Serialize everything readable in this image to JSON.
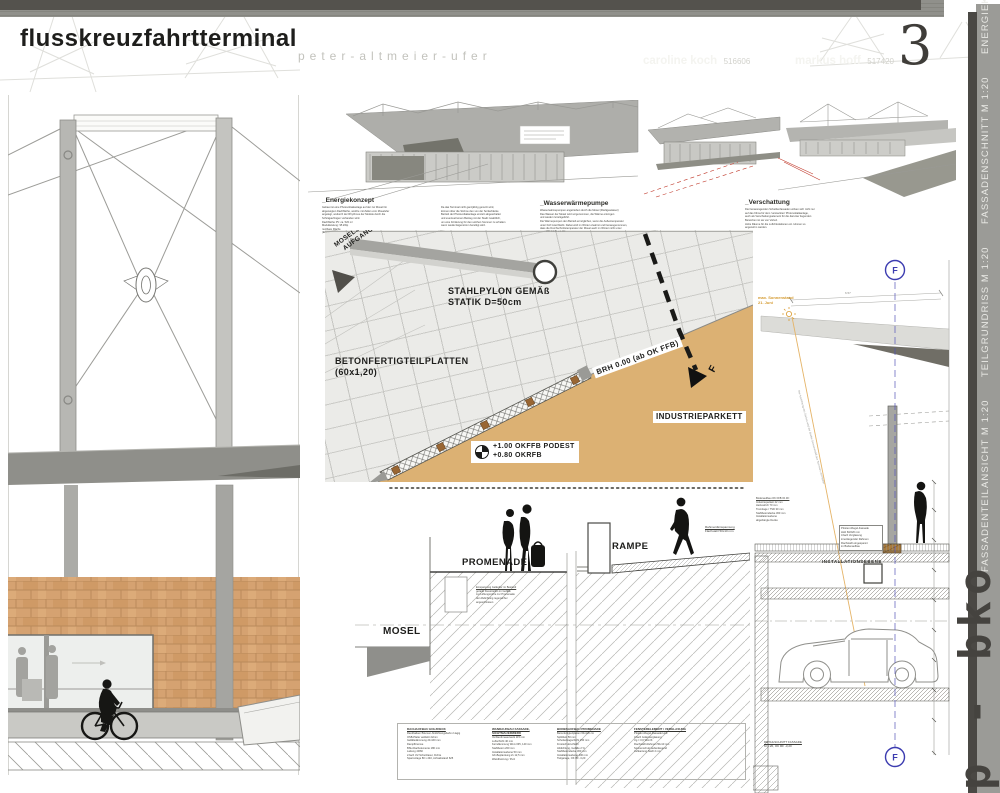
{
  "header": {
    "title": "flusskreuzfahrtterminal",
    "subtitle": "peter-altmeier-ufer",
    "authors": [
      {
        "name": "caroline koch",
        "id": "516606"
      },
      {
        "name": "markus hoff",
        "id": "517420"
      }
    ],
    "sheet_number": "3"
  },
  "sidebar": {
    "label": "FASSADENTEILANSICHT M 1:20      TEILGRUNDRISS M 1:20      FASSADENSCHNITT M 1:20      ENERGIEKONZEPT"
  },
  "signature": "p - bko",
  "colors": {
    "accent_blue": "#3c3cb0",
    "accent_orange": "#d99a2e",
    "tan": "#dcb173",
    "brick": "#d5a271",
    "band_gray": "#8d8d88",
    "band_dark": "#54524d"
  },
  "renderings": {
    "captions": [
      {
        "title": "_Energiekonzept",
        "col1": [
          "Gebaut ist eine Photovoltaikanlage auf der zur Mosel hin",
          "abgeneigten Dachfläche, welche mit Zellen vom Moselufer",
          "angelegt, wodurch der Rhythmus der Module durch die",
          "Schrägaufzügen vorhanden wird.",
          "Dachfläche PV: ca. 520 m²",
          "Modulleistung: 95 kWp",
          "nutzbare Fläche",
          "(Eigenwert)"
        ],
        "col2": [
          "Da das Terminal nicht ganzjährig genutzt wird,",
          "können über die Ströme den von der Sortierbänke",
          "Betrieb der Photovoltaikanlage einzeln abgeschaltet",
          "und eventuell einen Beitrag mit der Stadt zusätzlich,",
          "um eine Förderung für den solchen Sommer zu erhalten",
          "wenn wieder Eigenstrom benötigt wird."
        ]
      },
      {
        "title": "_Wasserwärmepumpe",
        "col1": [
          "Wasserwärmepumpen angetrieben durch die Mosel (Fließgewässer)",
          "Das Wasser der Mosel wird vorgenommen, die Wärme entzogen",
          "und wieder zurückgeführt.",
          "Die Wärmepumpen den Betrieb ermöglichen, wenn die Außentemperatur",
          "unter fünf Grad bleibt. Dabei wird im Winter erwärmt und herausgenommen,",
          "dass die Durchschnittstemperatur der Mosel auch im Winter nicht unter",
          "4,5 Grad fällt."
        ]
      },
      {
        "title": "_Verschattung",
        "col1": [
          "Die herausragenden Scheibenfassaden wirken sich nicht nur",
          "auf das Klima für dem 'versteckten' Photovoltaikanlage,",
          "auch als Verschattungselement für die darunter liegenden",
          "Bereichen ist sie von Vorteil.",
          "Hohe Räume für die Luftzirkulationen etc. können so",
          "angenehm werden."
        ]
      }
    ]
  },
  "plan": {
    "aufgang1": "MOSELSEITE",
    "aufgang2": "AUFGANG",
    "pylon1": "STAHLPYLON GEMÄß",
    "pylon2": "STATIK D=50cm",
    "beton1": "BETONFERTIGTEILPLATTEN",
    "beton2": "(60x1,20)",
    "brh": "BRH 0.00 (ab OK FFB)",
    "parkett": "INDUSTRIEPARKETT",
    "podest1": "+1.00 OKFFB PODEST",
    "podest2": "+0.80 OKRFB",
    "f": "F",
    "top_note": "OK FFB +1.00"
  },
  "section": {
    "promenade": "PROMENADE",
    "rampe": "RAMPE",
    "mosel": "MOSEL",
    "rahmen": [
      "Rahmen/Einspannung",
      "Flachstahl 50x10 mm"
    ],
    "ground_note": [
      "Einspannung Geländer im Bestand",
      "gerade Kiesstreifen im Gefälle",
      "zur Lüftungsrohre zur Promenade",
      "der Abdichtung regensicher",
      "angeschlossen"
    ]
  },
  "detail": {
    "sun1": "max. Sonnenstand",
    "sun2": "21. Juni",
    "sun_note": "Bei Ausrichtung des Daches wird der direkte Sonneneinfall des Sommers vermieden",
    "installationsebene": "INSTALLATIONSEBENE",
    "f": "F",
    "dim": "6.57",
    "left_note": [
      "Bodenaufbau OK FFB ±0.00:",
      "Industrieparkett 22 mm",
      "Heizestrich 70 mm",
      "Trennlage / TSD 30 mm",
      "Stahlbetondecke 300 mm",
      "Installationsebene",
      "abgehängte Decke"
    ],
    "window_note": [
      "Pfosten-Riegel-Fassade",
      "Holz 60/220 mm",
      "3-fach Verglasung",
      "innenliegender Rahmen",
      "Flachstahl eingespannt",
      "im Bodenaufbau"
    ],
    "bottom_note": [
      "DETAILSCHNITT FASSADE",
      "M 1:20, OK RF -3,20"
    ]
  },
  "legend": {
    "columns": [
      {
        "header": "DACHAUFBAU HOLZDECK",
        "lines": [
          "Randbalken Bitumen Abdichtungsbahn 2-lagig",
          "OSB-Platte verklebt 22mm",
          "Gefälledämmung 20-160 mm",
          "Dampfbremse",
          "BSH-Dachelemente 180 mm",
          "Lattung 40/60",
          "2-fach UV-Schutzlasur, Fichte",
          "Sparrenlage 80 x 240, Achsabstand 625"
        ]
      },
      {
        "header": "WANDAUFBAU FASSADE, SICHTMAUERWERK",
        "lines": [
          "Verblendmauerwerk 115 mm",
          "Luftschicht 40 mm",
          "Kerndämmung WLG 035, 140 mm",
          "Stahlbeton 200 mm",
          "Installationsebene 50 mm",
          "GK-Beplankung 2x 12,5 mm",
          "Wandheizung / Putz"
        ]
      },
      {
        "header": "BODENAUFBAU PROMENADE",
        "lines": [
          "Betonfertigteilplatten 60x120 cm",
          "Splittbett 50 mm",
          "Schottertragschicht 250 mm",
          "Frostschutzschicht",
          "Abdichtung, Gefälle 2 %",
          "Stahlbetondecke 300 mm",
          "Installationsebene 400 mm",
          "Tiefgarage, OK RF -3,20"
        ]
      },
      {
        "header": "FENSTERELEMENT / VERGLASUNG",
        "lines": [
          "Pfosten-Riegel-Fassade Holz",
          "3-fach Isolierverglasung",
          "Ug = 0,6 W/m²K",
          "Flachstahl-Rahmen 50x10 mm",
          "Sonnenschutz außenliegend",
          "Aufkantung Stahl 2 mm"
        ]
      }
    ]
  }
}
